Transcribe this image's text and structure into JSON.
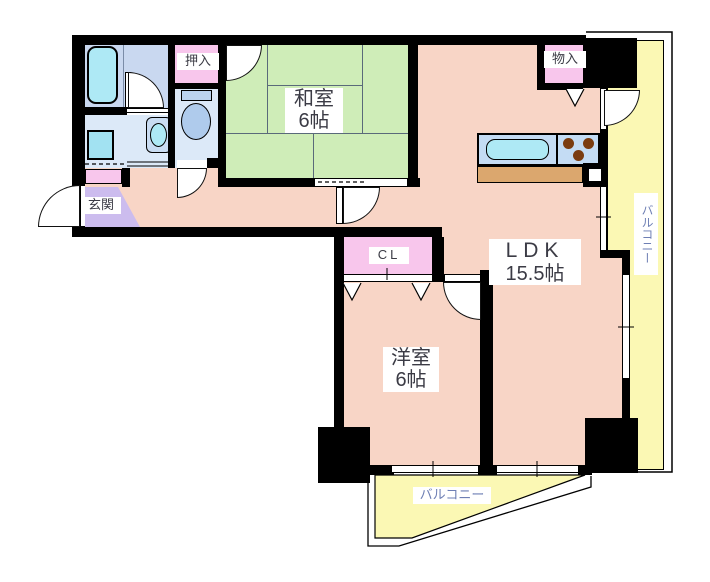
{
  "plan": {
    "type": "apartment-floor-plan",
    "rooms": {
      "washitsu": {
        "name": "和室",
        "size": "6帖"
      },
      "ldk": {
        "name": "LDK",
        "size": "15.5帖"
      },
      "yoshitsu": {
        "name": "洋室",
        "size": "6帖"
      },
      "genkan": {
        "label": "玄関"
      },
      "oshiire": {
        "label": "押入"
      },
      "monoire": {
        "label": "物入"
      },
      "closet": {
        "label": "CL"
      },
      "balcony_right": {
        "label": "バルコニー"
      },
      "balcony_bottom": {
        "label": "バルコニー"
      }
    },
    "colors": {
      "wall": "#000000",
      "room_pink": "#F8D5C6",
      "tatami_green": "#CFEDB8",
      "balcony_yellow": "#FBF8B4",
      "closet_pink": "#F8C6EC",
      "genkan_purple": "#CCBCEE",
      "bath_blue": "#C9D8F0",
      "wash_blue": "#DCE9F8",
      "fixture_cyan": "#AEE9F5",
      "counter_blue": "#C4DCF4",
      "cabinet_tan": "#DBA76E",
      "burner_brown": "#7B3C10",
      "label_text": "#3B3B45",
      "balcony_text": "#6E7FB4"
    }
  }
}
